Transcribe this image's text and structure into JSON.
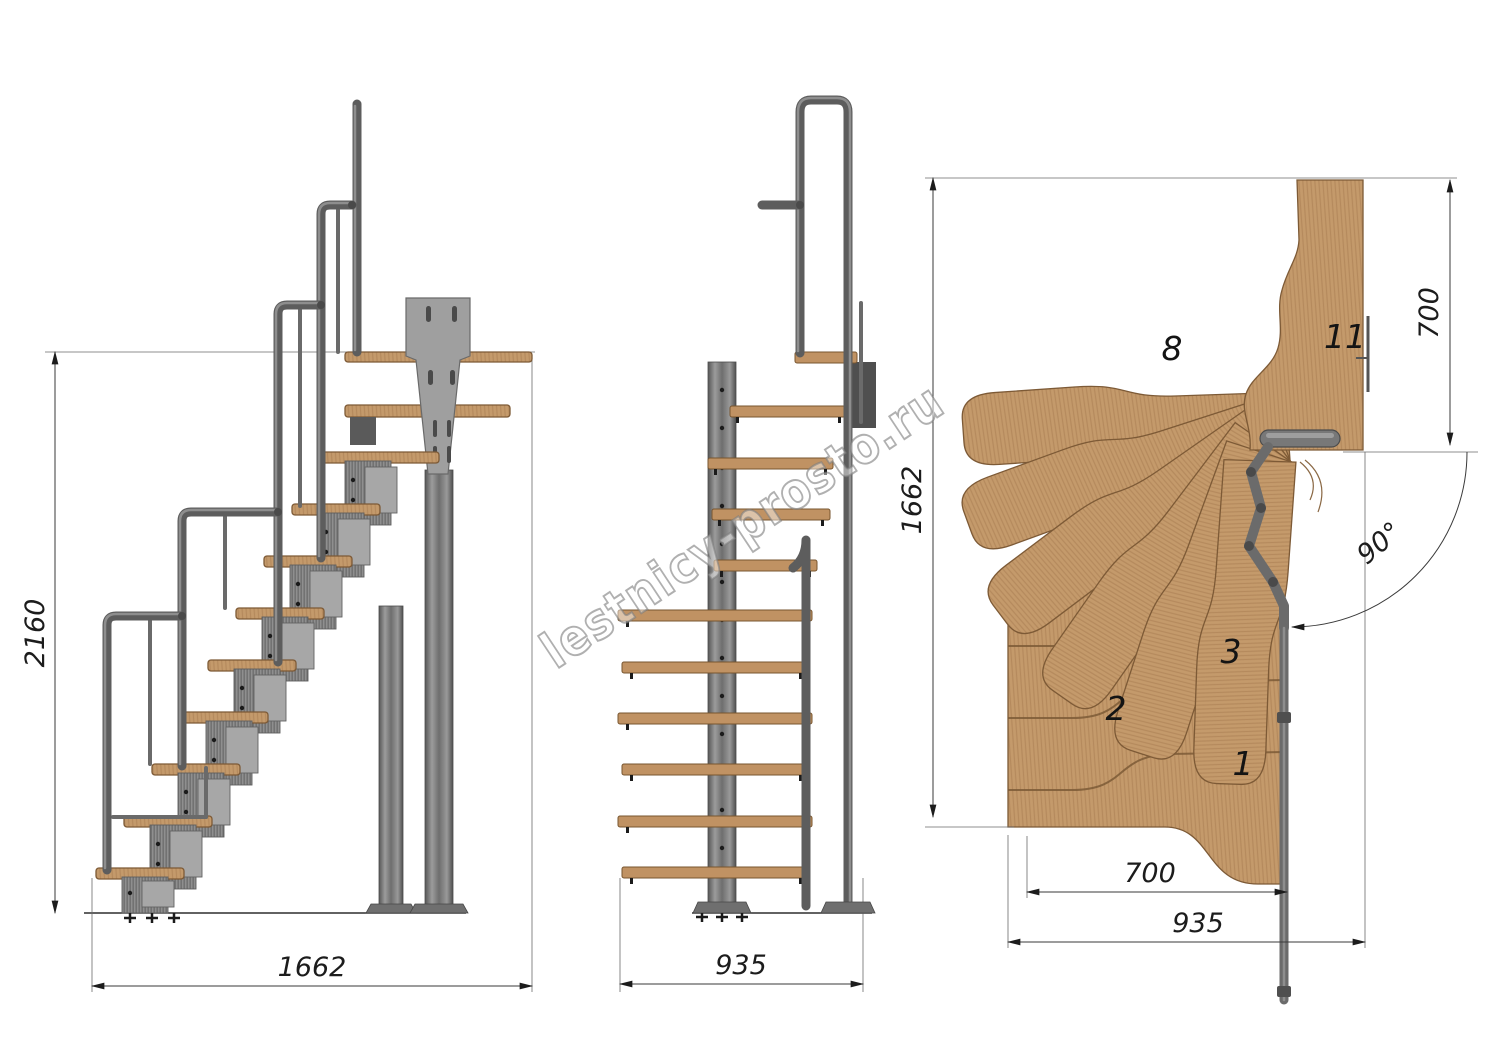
{
  "drawing": {
    "type": "staircase-technical-drawing",
    "views": [
      "side-elevation",
      "front-elevation",
      "plan-view"
    ]
  },
  "watermark": {
    "text": "lestnicy-prosto.ru"
  },
  "dimensions": {
    "side_height": "2160",
    "side_length": "1662",
    "front_width": "935",
    "plan_depth": "1662",
    "plan_exit_width": "700",
    "plan_turn_angle": "90°",
    "plan_tread_run": "700",
    "plan_total_width": "935"
  },
  "plan_step_labels": {
    "first": "1",
    "second": "2",
    "third": "3",
    "eighth": "8",
    "eleventh": "11"
  },
  "colors": {
    "wood": "#c49a6b",
    "wood_edge": "#7d5a36",
    "metal": "#8f8f8f",
    "metal_dark": "#5d5d5d",
    "dimension_ink": "#1c1c1c",
    "watermark_gray": "#a5a5a5",
    "background": "#ffffff"
  }
}
